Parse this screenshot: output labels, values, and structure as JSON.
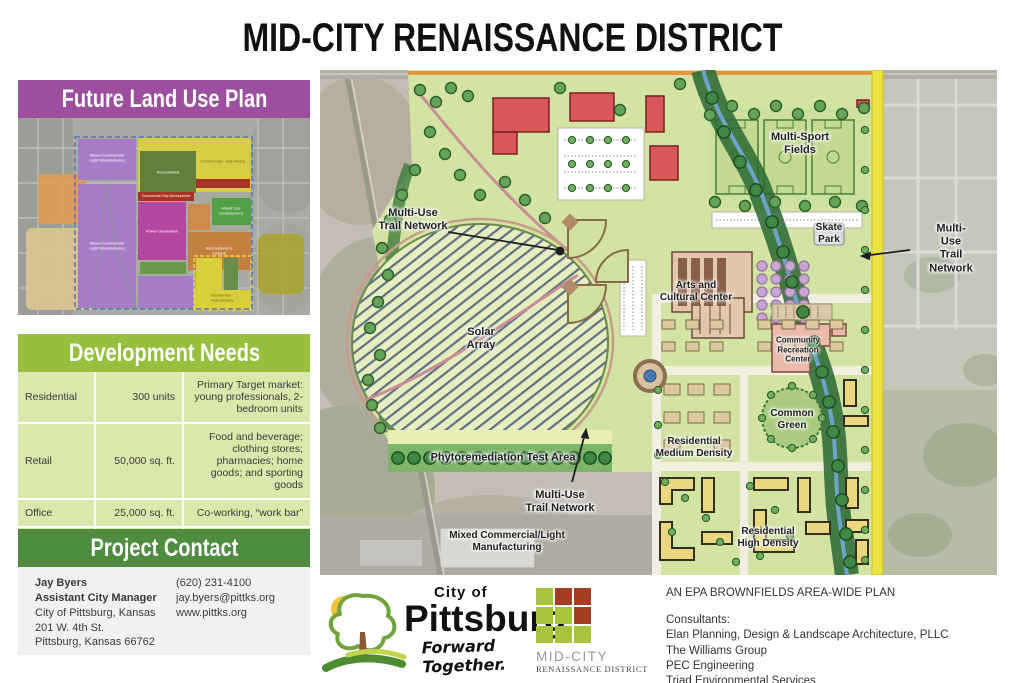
{
  "title": "MID-CITY RENAISSANCE DISTRICT",
  "colors": {
    "header_purple": "#9c4f9e",
    "header_green": "#95c03e",
    "header_dark_green": "#4e8c40",
    "table_bg": "#dbe8ac",
    "logo_green": "#a8c43c",
    "logo_red": "#a63d22",
    "road_yellow": "#ece23f"
  },
  "sidebar": {
    "land_use": {
      "header": "Future Land Use Plan",
      "zones": [
        {
          "name": "Mixed Commercial/\nLight Manufacturing"
        },
        {
          "name": "Recreational"
        },
        {
          "name": "Commercial - Gas Ready"
        },
        {
          "name": "Commercial Strip Development"
        },
        {
          "name": "Power Generation"
        },
        {
          "name": "Mixed Use\nDevelopment"
        },
        {
          "name": "Recreational &\nCultural"
        },
        {
          "name": "Mixed Commercial/\nLight Manufacturing"
        },
        {
          "name": "Residential -\nHigh Density"
        }
      ]
    },
    "development_needs": {
      "header": "Development Needs",
      "rows": [
        {
          "category": "Residential",
          "amount": "300 units",
          "description": "Primary Target market: young professionals, 2-bedroom units"
        },
        {
          "category": "Retail",
          "amount": "50,000 sq. ft.",
          "description": "Food and beverage; clothing stores; pharmacies; home goods; and sporting goods"
        },
        {
          "category": "Office",
          "amount": "25,000 sq. ft.",
          "description": "Co-working, “work bar”"
        },
        {
          "category": "Light Industrial",
          "amount": "25,000 sq. ft.",
          "description": "“Build-to-suit” flexible tech space"
        }
      ]
    },
    "contact": {
      "header": "Project Contact",
      "name": "Jay Byers",
      "role": "Assistant City Manager",
      "org": "City of Pittsburg, Kansas",
      "address": "201 W. 4th St.",
      "city": "Pittsburg, Kansas 66762",
      "phone": "(620) 231-4100",
      "email": "jay.byers@pittks.org",
      "website": "www.pittks.org"
    }
  },
  "map": {
    "labels": [
      {
        "text": "Multi-Use\nTrail Network"
      },
      {
        "text": "Multi-Sport\nFields"
      },
      {
        "text": "Skate\nPark"
      },
      {
        "text": "Multi-Use\nTrail Network"
      },
      {
        "text": "Arts and\nCultural Center"
      },
      {
        "text": "Solar\nArray"
      },
      {
        "text": "Community\nRecreation\nCenter"
      },
      {
        "text": "Common\nGreen"
      },
      {
        "text": "Residential\nMedium Density"
      },
      {
        "text": "Phytoremediation Test Area"
      },
      {
        "text": "Multi-Use\nTrail Network"
      },
      {
        "text": "Mixed Commercial/Light\nManufacturing"
      },
      {
        "text": "Residential\nHigh Density"
      }
    ]
  },
  "footer": {
    "city_logo": {
      "top": "City of",
      "name": "Pittsburg",
      "tagline": "Forward Together."
    },
    "district_logo": {
      "name": "MID-CITY",
      "subtitle": "RENAISSANCE DISTRICT"
    },
    "plan_type": "AN EPA BROWNFIELDS AREA-WIDE PLAN",
    "consultants_label": "Consultants:",
    "consultants": [
      "Elan Planning, Design & Landscape Architecture, PLLC",
      "The Williams Group",
      "PEC Engineering",
      "Triad Environmental Services"
    ]
  }
}
